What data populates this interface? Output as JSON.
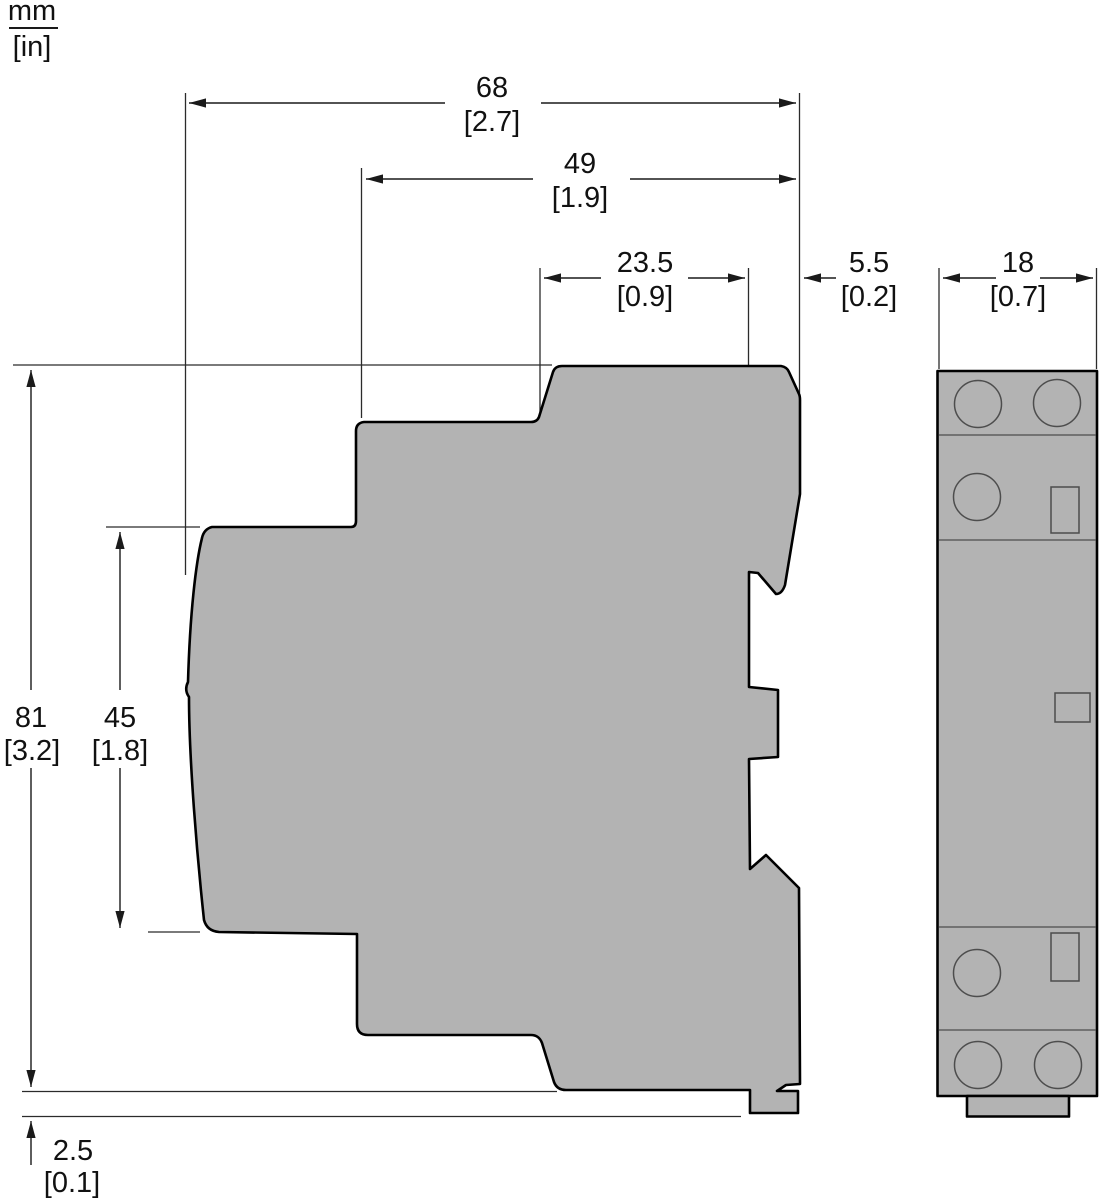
{
  "unit_legend": {
    "numerator": "mm",
    "denominator": "[in]"
  },
  "dimensions": {
    "overall_depth": {
      "mm": "68",
      "in": "[2.7]"
    },
    "body_depth": {
      "mm": "49",
      "in": "[1.9]"
    },
    "front_depth": {
      "mm": "23.5",
      "in": "[0.9]"
    },
    "rear_offset": {
      "mm": "5.5",
      "in": "[0.2]"
    },
    "module_width": {
      "mm": "18",
      "in": "[0.7]"
    },
    "overall_height": {
      "mm": "81",
      "in": "[3.2]"
    },
    "front_height": {
      "mm": "45",
      "in": "[1.8]"
    },
    "foot_height": {
      "mm": "2.5",
      "in": "[0.1]"
    }
  },
  "colors": {
    "body_fill": "#b3b3b3",
    "outline": "#000000",
    "detail_line": "#4d4d4d",
    "background": "#ffffff",
    "text": "#111111"
  }
}
